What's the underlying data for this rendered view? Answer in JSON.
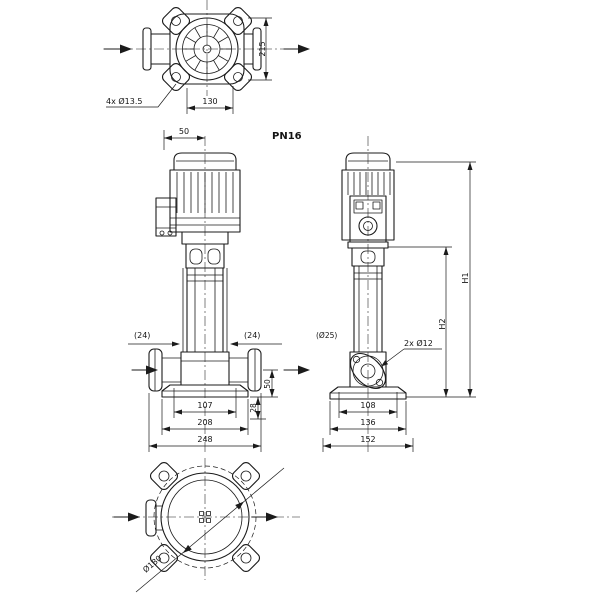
{
  "drawing": {
    "kind": "pump-technical-drawing",
    "colors": {
      "line": "#1b1b1b",
      "background": "#ffffff"
    },
    "icons": {
      "flow_arrow_icon": "▶"
    },
    "pressure_rating": "PN16",
    "top_view": {
      "dim_depth": "215",
      "dim_hole_spacing": "130",
      "label_bolt_holes": "4x Ø13.5"
    },
    "front_view": {
      "dim_top_width": "50",
      "label_left_port": "(24)",
      "label_right_port": "(24)",
      "dim_port_height": "50",
      "dim_base_height": "28",
      "dim_base_inner": "107",
      "dim_base_middle": "208",
      "dim_base_outer": "248"
    },
    "side_view": {
      "label_pipe_bore": "(Ø25)",
      "label_base_holes": "2x Ø12",
      "dim_height_pump": "H2",
      "dim_height_total": "H1",
      "dim_base_inner": "108",
      "dim_base_middle": "136",
      "dim_base_outer": "152"
    },
    "bottom_view": {
      "dim_diameter": "Ø180"
    }
  }
}
